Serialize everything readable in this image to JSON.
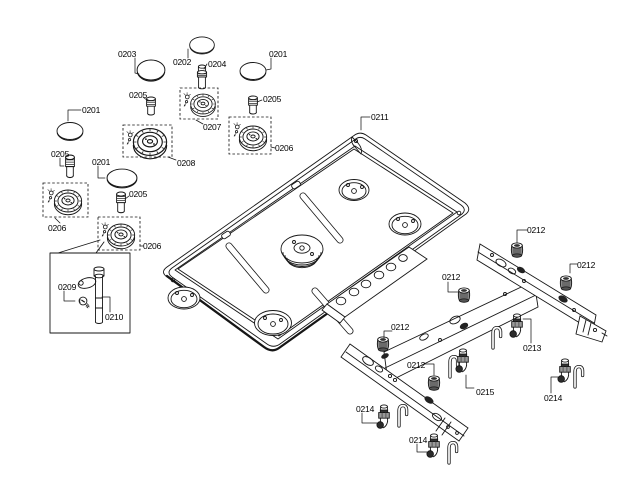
{
  "diagram": {
    "background": "#ffffff",
    "line_color": "#161616",
    "parts": {
      "0201": "0201",
      "0202": "0202",
      "0203": "0203",
      "0204": "0204",
      "0205": "0205",
      "0206": "0206",
      "0207": "0207",
      "0208": "0208",
      "0209": "0209",
      "0210": "0210",
      "0211": "0211",
      "0212": "0212",
      "0213": "0213",
      "0214": "0214",
      "0215": "0215"
    }
  }
}
